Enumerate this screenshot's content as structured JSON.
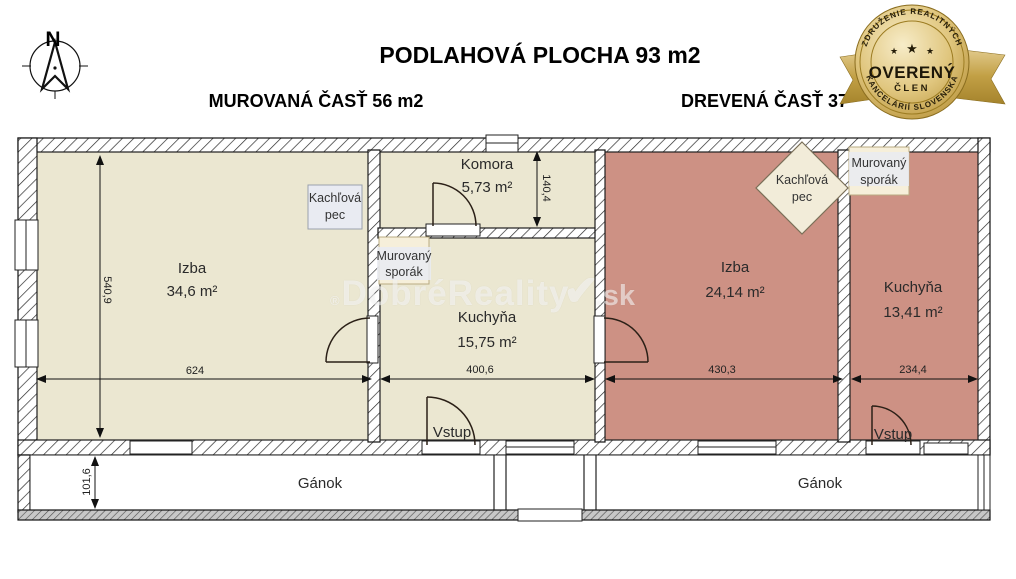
{
  "header": {
    "title": "PODLAHOVÁ PLOCHA 93 m2",
    "subtitle_left": "MUROVANÁ ČASŤ 56 m2",
    "subtitle_right": "DREVENÁ ČASŤ 37"
  },
  "compass": {
    "north_label": "N"
  },
  "badge": {
    "arc_top": "ZDRUŽENIE REALITNÝCH",
    "arc_bottom": "KANCELÁRIÍ SLOVENSKA",
    "title": "OVERENÝ",
    "subtitle": "ČLEN",
    "star_glyph": "★",
    "gold_color": "#c9a445"
  },
  "watermark": {
    "registered_glyph": "®",
    "main": "DobréReality",
    "check_glyph": "✔",
    "suffix": ".sk"
  },
  "plan": {
    "colors": {
      "masonry_fill": "#ebe7d1",
      "wood_fill": "#cd9184",
      "fixture_box_fill": "#f6efda",
      "label_box_fill": "#e9ebf2"
    },
    "rooms": {
      "izba_left": {
        "name": "Izba",
        "area": "34,6 m²"
      },
      "komora": {
        "name": "Komora",
        "area": "5,73 m²"
      },
      "kuchyna_left": {
        "name": "Kuchyňa",
        "area": "15,75 m²"
      },
      "izba_right": {
        "name": "Izba",
        "area": "24,14 m²"
      },
      "kuchyna_right": {
        "name": "Kuchyňa",
        "area": "13,41 m²"
      },
      "ganok_left": {
        "name": "Gánok"
      },
      "ganok_right": {
        "name": "Gánok"
      },
      "vstup_left": {
        "name": "Vstup"
      },
      "vstup_right": {
        "name": "Vstup"
      }
    },
    "fixtures": {
      "kachlova_pec_left": {
        "line1": "Kachľová",
        "line2": "pec"
      },
      "murovany_sporak_left": {
        "line1": "Murovaný",
        "line2": "sporák"
      },
      "kachlova_pec_right": {
        "line1": "Kachľová",
        "line2": "pec"
      },
      "murovany_sporak_right": {
        "line1": "Murovaný",
        "line2": "sporák"
      }
    },
    "dimensions": {
      "izba_left_width": "624",
      "kuchyna_left_width": "400,6",
      "izba_right_width": "430,3",
      "kuchyna_right_width": "234,4",
      "left_height": "540,9",
      "komora_height": "140,4",
      "ganok_height": "101,6"
    }
  }
}
